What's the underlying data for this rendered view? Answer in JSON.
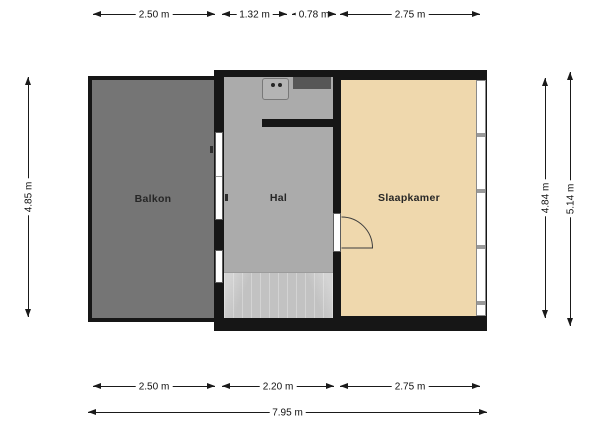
{
  "floorplan": {
    "rooms": {
      "balkon": {
        "label": "Balkon"
      },
      "hal": {
        "label": "Hal"
      },
      "slaapkamer": {
        "label": "Slaapkamer"
      }
    },
    "dimensions": {
      "top": {
        "balkon_width": "2.50 m",
        "hal_left_width": "1.32 m",
        "shaft_width": "0.78 m",
        "slaapkamer_width": "2.75 m"
      },
      "bottom": {
        "balkon_width": "2.50 m",
        "hal_width": "2.20 m",
        "slaapkamer_width": "2.75 m",
        "total_width": "7.95 m"
      },
      "left": {
        "balkon_height": "4.85 m"
      },
      "right": {
        "inner_height": "4.84 m",
        "outer_height": "5.14 m"
      }
    },
    "colors": {
      "wall": "#161616",
      "balkon_floor": "#757575",
      "hal_floor": "#ababab",
      "slaapkamer_floor": "#efd8ad",
      "stairs_floor": "#c2c2c2",
      "shaft": "#565656",
      "background": "#ffffff"
    },
    "features": {
      "stairs": "staircase",
      "balcony_door": "balcony-door",
      "hal_window": "window",
      "slaapkamer_window": "window",
      "slaapkamer_door": "hinged-door",
      "boiler": "boiler-unit",
      "shaft": "duct-shaft"
    }
  }
}
